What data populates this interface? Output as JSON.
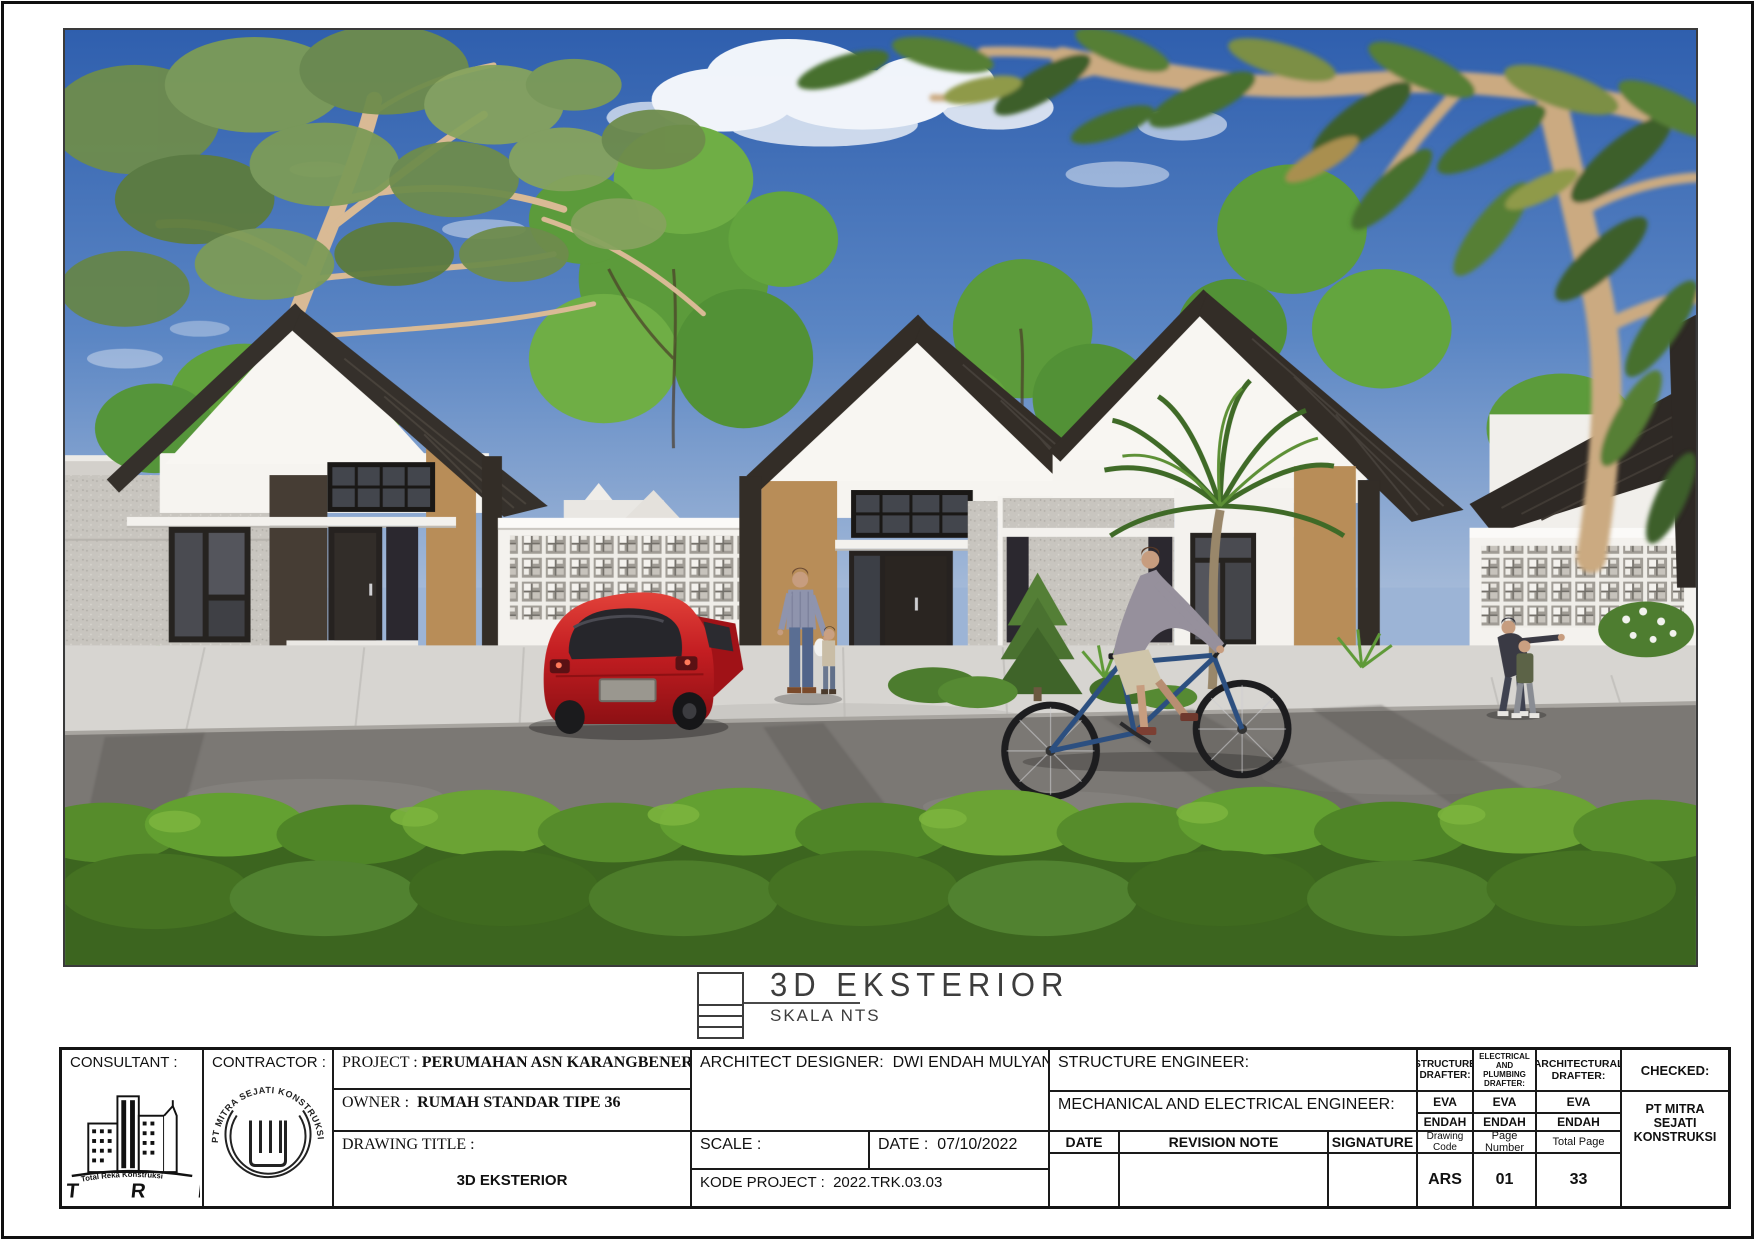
{
  "caption": {
    "title": "3D  EKSTERIOR",
    "subtitle": "SKALA  NTS"
  },
  "titleblock": {
    "consultant_label": "CONSULTANT :",
    "contractor_label": "CONTRACTOR :",
    "consultant_logo": {
      "banner": "Total Reka Konstruksi",
      "initials": "T R K"
    },
    "contractor_stamp": "PT MITRA SEJATI KONSTRUKSI",
    "project": {
      "label": "PROJECT :",
      "value": "PERUMAHAN ASN KARANGBENER"
    },
    "owner": {
      "label": "OWNER :",
      "value": "RUMAH STANDAR TIPE 36"
    },
    "drawing_title": {
      "label": "DRAWING TITLE :",
      "value": "3D EKSTERIOR"
    },
    "architect": {
      "label": "ARCHITECT DESIGNER:",
      "value": "DWI ENDAH MULYANI"
    },
    "scale": {
      "label": "SCALE :",
      "value": ""
    },
    "date": {
      "label": "DATE :",
      "value": "07/10/2022"
    },
    "kode_project": {
      "label": "KODE PROJECT :",
      "value": "2022.TRK.03.03"
    },
    "structure_engineer_label": "STRUCTURE ENGINEER:",
    "me_engineer_label": "MECHANICAL AND ELECTRICAL ENGINEER:",
    "revision": {
      "headers": [
        "DATE",
        "REVISION NOTE",
        "SIGNATURE"
      ]
    },
    "drafters": [
      {
        "title": "STRUCTURE DRAFTER:",
        "row1": "EVA",
        "row2": "ENDAH",
        "footer_label": "Drawing Code",
        "footer_value": "ARS"
      },
      {
        "title": "ELECTRICAL AND PLUMBING DRAFTER:",
        "row1": "EVA",
        "row2": "ENDAH",
        "footer_label": "Page Number",
        "footer_value": "01"
      },
      {
        "title": "ARCHITECTURAL DRAFTER:",
        "row1": "EVA",
        "row2": "ENDAH",
        "footer_label": "Total Page",
        "footer_value": "33"
      }
    ],
    "checked": {
      "label": "CHECKED:",
      "value": "PT MITRA SEJATI KONSTRUKSI"
    }
  },
  "scene": {
    "description": "3D exterior render of a row of three type-36 gable-roof houses with breeze-block fences, red hatchback car, pedestrians and a cyclist on the street, foreground hedge and overhanging trees",
    "colors": {
      "sky": "#2f5fae",
      "roof": "#332d27",
      "accent_tan": "#b88d58",
      "wall_white": "#f4f2ee",
      "wall_gray": "#c8c5bf",
      "car_red": "#c41e22",
      "grass": "#6aa838",
      "road": "#7b7874"
    }
  }
}
